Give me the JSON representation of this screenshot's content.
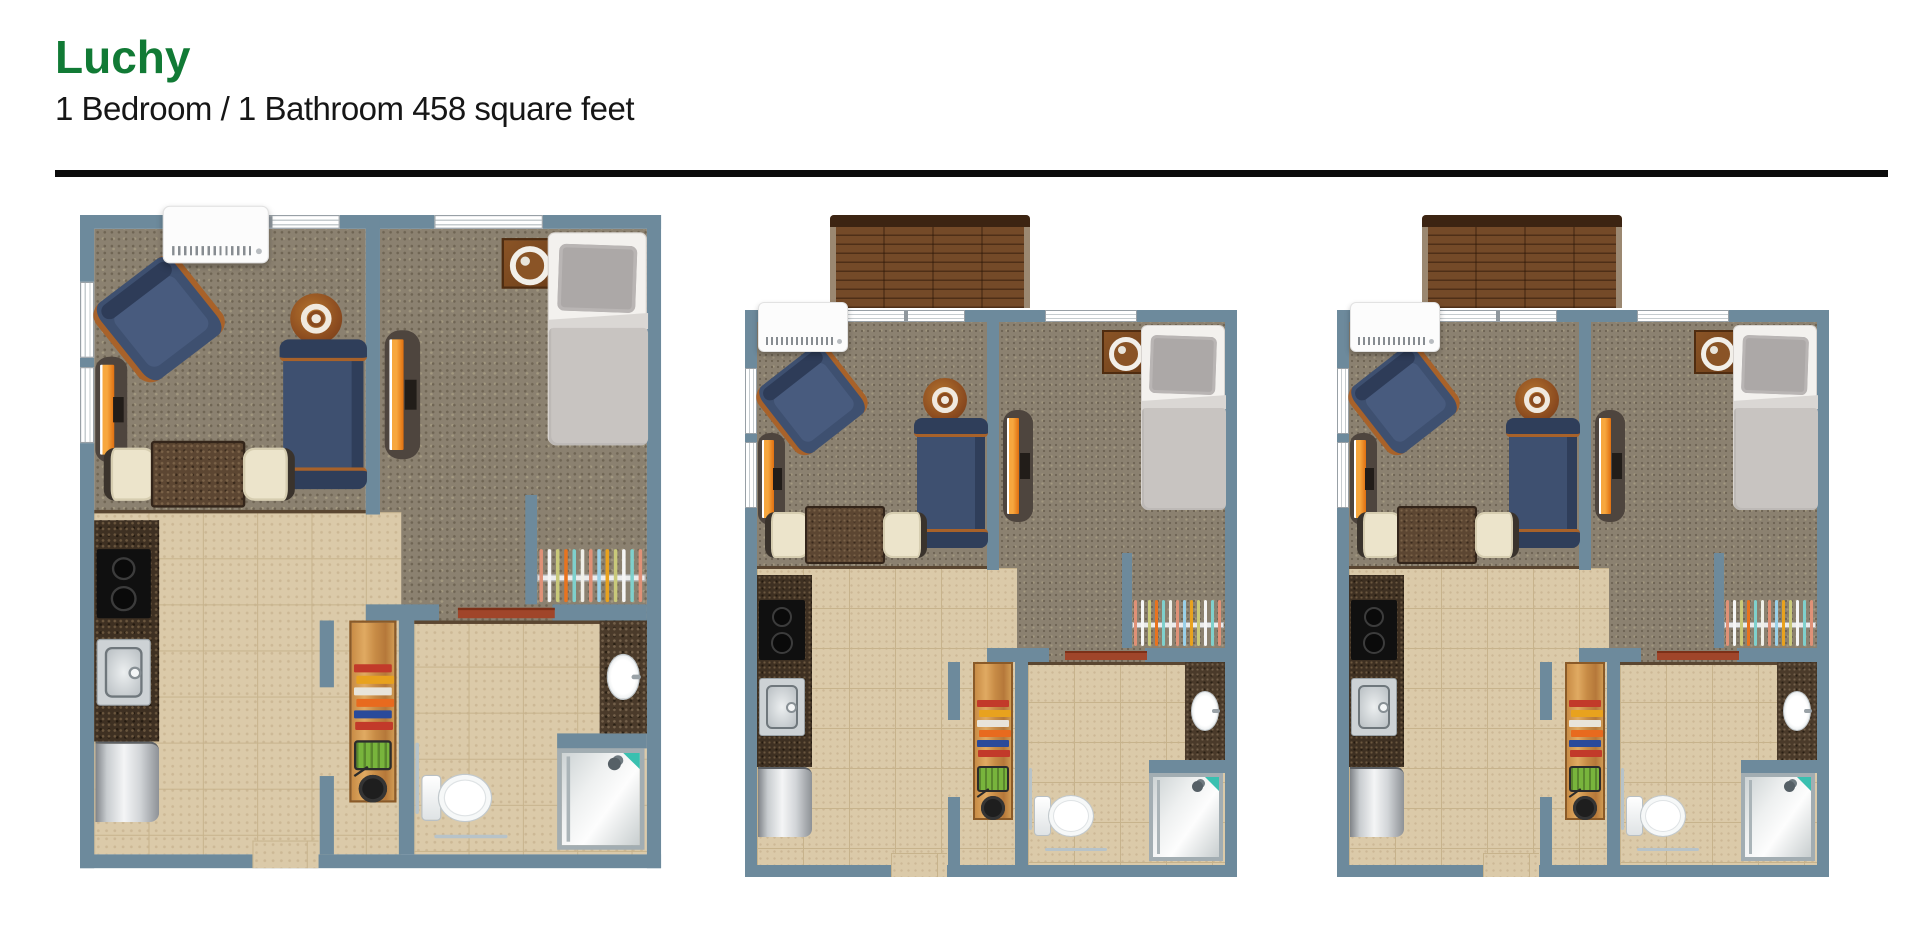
{
  "header": {
    "title": "Luchy",
    "subtitle": "1 Bedroom / 1 Bathroom 458 square feet"
  },
  "floor_plans": [
    {
      "id": "floor-plan-1",
      "position": "a",
      "deck": false,
      "label": "Luchy unit floor plan"
    },
    {
      "id": "floor-plan-2",
      "position": "b",
      "deck": true,
      "label": "Luchy unit floor plan with deck"
    },
    {
      "id": "floor-plan-3",
      "position": "c",
      "deck": true,
      "label": "Luchy unit floor plan with deck"
    }
  ],
  "plan_contents": {
    "rooms": [
      "living-room",
      "bedroom",
      "kitchen",
      "bathroom",
      "closet",
      "hallway"
    ],
    "furniture_icons": [
      "ac-unit",
      "window",
      "armchair",
      "loveseat",
      "round-side-table",
      "tv-stand",
      "dining-table",
      "dining-chair",
      "kitchen-counter",
      "stove",
      "kitchen-sink",
      "refrigerator",
      "pantry-shelf",
      "bed",
      "pillow",
      "nightstand-lamp",
      "closet-hangers",
      "toilet",
      "grab-bar",
      "shower",
      "vanity-sink",
      "sliding-door-track",
      "deck"
    ]
  },
  "colors": {
    "title_green": "#117a35",
    "divider_black": "#0b0b0b",
    "wall_blue_gray": "#6d8a9c",
    "carpet_brown": "#8b8170",
    "tile_beige": "#dbcaa9",
    "deck_wood": "#744a28",
    "sofa_navy": "#3e5070",
    "wood_trim": "#a8622a",
    "tv_orange": "#e8821e",
    "door_track_rust": "#a0452a"
  }
}
